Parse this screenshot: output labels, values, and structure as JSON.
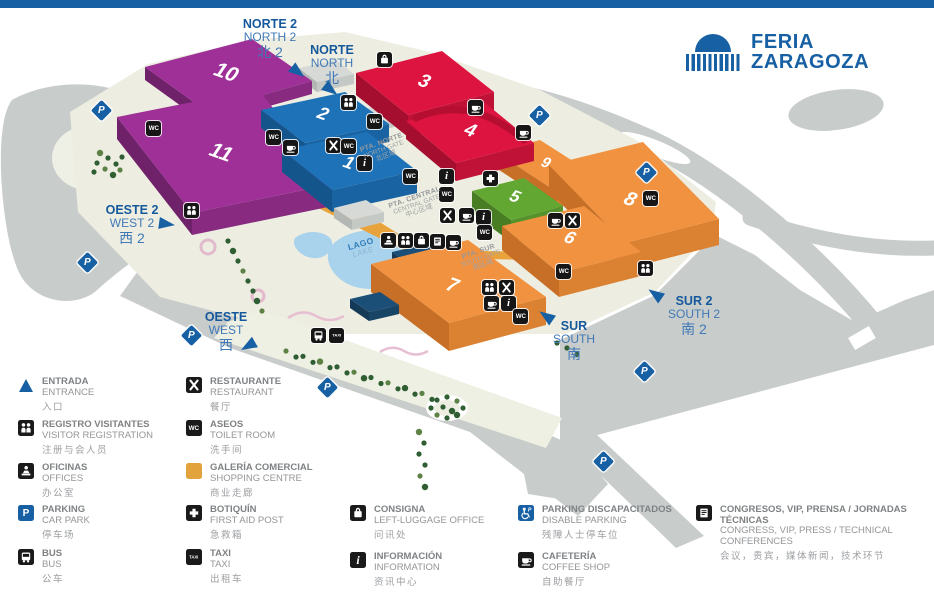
{
  "top_bar": {
    "color": "#1660a3"
  },
  "logo": {
    "line1": "FERIA",
    "line2": "ZARAGOZA",
    "color": "#1660a3"
  },
  "palette": {
    "ground": "#edeee1",
    "road": "#c8cccb",
    "lake": "#a9d2ec",
    "accent_blue": "#1660a3",
    "buildings": {
      "purple": {
        "roof": "#9e3097",
        "left": "#6f2169",
        "right": "#872a80"
      },
      "blue": {
        "roof": "#1e72b8",
        "left": "#14568c",
        "right": "#1963a2"
      },
      "red": {
        "roof": "#dd1440",
        "left": "#a60e2f",
        "right": "#c01137"
      },
      "orange": {
        "roof": "#f0923f",
        "left": "#c76f26",
        "right": "#db8132"
      },
      "green": {
        "roof": "#63a733",
        "left": "#497d24",
        "right": "#56922b"
      },
      "navy": {
        "roof": "#1c4f78",
        "left": "#143a58",
        "right": "#184466"
      },
      "gray": {
        "roof": "#d6d9d6",
        "left": "#b4b8b5",
        "right": "#c5c9c6"
      }
    }
  },
  "map": {
    "structures": [
      {
        "n": "",
        "c": "gray",
        "roof": [
          [
            299,
            68
          ],
          [
            336,
            60
          ],
          [
            354,
            74
          ],
          [
            317,
            82
          ]
        ],
        "h": 10
      },
      {
        "n": "",
        "c": "gray",
        "roof": [
          [
            352,
            112
          ],
          [
            380,
            105
          ],
          [
            398,
            118
          ],
          [
            370,
            125
          ]
        ],
        "h": 8
      },
      {
        "n": "10",
        "c": "purple",
        "roof": [
          [
            145,
            67
          ],
          [
            252,
            39
          ],
          [
            312,
            81
          ],
          [
            206,
            111
          ]
        ],
        "h": 13,
        "lx": 226,
        "ly": 73,
        "fs": 21
      },
      {
        "n": "11",
        "c": "purple",
        "roof": [
          [
            117,
            117
          ],
          [
            258,
            89
          ],
          [
            333,
            184
          ],
          [
            192,
            213
          ]
        ],
        "h": 22,
        "lx": 221,
        "ly": 153,
        "fs": 21
      },
      {
        "n": "2",
        "c": "blue",
        "roof": [
          [
            261,
            110
          ],
          [
            345,
            92
          ],
          [
            389,
            124
          ],
          [
            305,
            143
          ]
        ],
        "h": 18,
        "lx": 323,
        "ly": 114,
        "fs": 18
      },
      {
        "n": "1",
        "c": "blue",
        "roof": [
          [
            282,
            150
          ],
          [
            367,
            132
          ],
          [
            417,
            171
          ],
          [
            332,
            190
          ]
        ],
        "h": 22,
        "lx": 349,
        "ly": 163,
        "fs": 18
      },
      {
        "n": "3",
        "c": "red",
        "roof": [
          [
            356,
            73
          ],
          [
            442,
            51
          ],
          [
            494,
            92
          ],
          [
            408,
            115
          ]
        ],
        "h": 22,
        "lx": 424,
        "ly": 82,
        "fs": 19
      },
      {
        "n": "9",
        "c": "orange",
        "roof": [
          [
            496,
            152
          ],
          [
            540,
            140
          ],
          [
            601,
            179
          ],
          [
            557,
            192
          ]
        ],
        "h": 16,
        "lx": 546,
        "ly": 163,
        "fs": 15
      },
      {
        "n": "4",
        "c": "red",
        "roof": [
          [
            406,
            121
          ],
          [
            484,
            102
          ],
          [
            534,
            143
          ],
          [
            456,
            163
          ]
        ],
        "h": 18,
        "lx": 470,
        "ly": 131,
        "fs": 19,
        "dome": true
      },
      {
        "n": "8",
        "c": "orange",
        "roof": [
          [
            549,
            165
          ],
          [
            643,
            142
          ],
          [
            719,
            219
          ],
          [
            625,
            243
          ]
        ],
        "h": 26,
        "lx": 630,
        "ly": 200,
        "fs": 20
      },
      {
        "n": "5",
        "c": "green",
        "roof": [
          [
            472,
            191
          ],
          [
            524,
            178
          ],
          [
            563,
            206
          ],
          [
            511,
            220
          ]
        ],
        "h": 22,
        "lx": 515,
        "ly": 197,
        "fs": 17
      },
      {
        "n": "",
        "c": "gray",
        "roof": [
          [
            334,
            208
          ],
          [
            366,
            200
          ],
          [
            384,
            212
          ],
          [
            352,
            220
          ]
        ],
        "h": 10
      },
      {
        "n": "",
        "c": "navy",
        "roof": [
          [
            392,
            252
          ],
          [
            440,
            241
          ],
          [
            472,
            262
          ],
          [
            424,
            274
          ]
        ],
        "h": 13
      },
      {
        "n": "6",
        "c": "orange",
        "roof": [
          [
            502,
            226
          ],
          [
            584,
            206
          ],
          [
            641,
            252
          ],
          [
            559,
            273
          ]
        ],
        "h": 24,
        "lx": 570,
        "ly": 238,
        "fs": 18
      },
      {
        "n": "7",
        "c": "orange",
        "roof": [
          [
            371,
            264
          ],
          [
            468,
            240
          ],
          [
            546,
            297
          ],
          [
            449,
            323
          ]
        ],
        "h": 28,
        "lx": 452,
        "ly": 286,
        "fs": 20
      },
      {
        "n": "",
        "c": "navy",
        "roof": [
          [
            350,
            299
          ],
          [
            380,
            292
          ],
          [
            399,
            305
          ],
          [
            369,
            312
          ]
        ],
        "h": 9
      }
    ],
    "directions": [
      {
        "id": "norte2",
        "es": "NORTE 2",
        "en": "NORTH 2",
        "zh": "北 2",
        "x": 270,
        "y": 18,
        "ax": 298,
        "ay": 72,
        "rot": 38
      },
      {
        "id": "norte",
        "es": "NORTE",
        "en": "NORTH",
        "zh": "北",
        "x": 332,
        "y": 44,
        "ax": 331,
        "ay": 90,
        "rot": 38
      },
      {
        "id": "oeste2",
        "es": "OESTE 2",
        "en": "WEST 2",
        "zh": "西 2",
        "x": 132,
        "y": 204,
        "ax": 167,
        "ay": 224,
        "rot": 8
      },
      {
        "id": "oeste",
        "es": "OESTE",
        "en": "WEST",
        "zh": "西",
        "x": 226,
        "y": 311,
        "ax": 248,
        "ay": 346,
        "rot": 150
      },
      {
        "id": "sur",
        "es": "SUR",
        "en": "SOUTH",
        "zh": "南",
        "x": 574,
        "y": 320,
        "ax": 546,
        "ay": 316,
        "rot": 215
      },
      {
        "id": "sur2",
        "es": "SUR 2",
        "en": "SOUTH 2",
        "zh": "南 2",
        "x": 694,
        "y": 295,
        "ax": 655,
        "ay": 294,
        "rot": 215
      }
    ],
    "gates": [
      {
        "id": "pta-norte",
        "es": "PTA. NORTE",
        "en": "NORTH GATE",
        "zh": "北区域",
        "x": 384,
        "y": 150,
        "rot": -20
      },
      {
        "id": "pta-central",
        "es": "PTA. CENTRAL",
        "en": "CENTRAL GATE",
        "zh": "中心区域",
        "x": 417,
        "y": 205,
        "rot": -19
      },
      {
        "id": "pta-sur",
        "es": "PTA. SUR",
        "en": "SOUTH GATE",
        "zh": "南区域",
        "x": 481,
        "y": 259,
        "rot": -19
      }
    ],
    "lake_label": {
      "es": "LAGO",
      "en": "LAKE",
      "x": 362,
      "y": 248
    },
    "icons": [
      {
        "t": "wc",
        "x": 146,
        "y": 121
      },
      {
        "t": "wc",
        "x": 266,
        "y": 130
      },
      {
        "t": "coffee",
        "x": 283,
        "y": 140
      },
      {
        "t": "reg",
        "x": 341,
        "y": 95
      },
      {
        "t": "bag",
        "x": 377,
        "y": 52
      },
      {
        "t": "wc",
        "x": 367,
        "y": 114
      },
      {
        "t": "rest",
        "x": 326,
        "y": 138
      },
      {
        "t": "wc",
        "x": 341,
        "y": 139
      },
      {
        "t": "info",
        "x": 357,
        "y": 156
      },
      {
        "t": "coffee",
        "x": 468,
        "y": 100
      },
      {
        "t": "wc",
        "x": 403,
        "y": 169
      },
      {
        "t": "info",
        "x": 439,
        "y": 169
      },
      {
        "t": "wc",
        "x": 439,
        "y": 187
      },
      {
        "t": "aid",
        "x": 483,
        "y": 171
      },
      {
        "t": "coffee",
        "x": 516,
        "y": 125
      },
      {
        "t": "rest",
        "x": 440,
        "y": 208
      },
      {
        "t": "coffee",
        "x": 459,
        "y": 208
      },
      {
        "t": "info",
        "x": 476,
        "y": 210
      },
      {
        "t": "wc",
        "x": 477,
        "y": 225
      },
      {
        "t": "ofi",
        "x": 381,
        "y": 233
      },
      {
        "t": "reg",
        "x": 398,
        "y": 233
      },
      {
        "t": "bag",
        "x": 414,
        "y": 233
      },
      {
        "t": "cong",
        "x": 430,
        "y": 234
      },
      {
        "t": "coffee",
        "x": 446,
        "y": 235
      },
      {
        "t": "reg",
        "x": 482,
        "y": 280
      },
      {
        "t": "rest",
        "x": 499,
        "y": 280
      },
      {
        "t": "coffee",
        "x": 484,
        "y": 296
      },
      {
        "t": "info",
        "x": 501,
        "y": 296
      },
      {
        "t": "wc",
        "x": 513,
        "y": 309
      },
      {
        "t": "coffee",
        "x": 548,
        "y": 213
      },
      {
        "t": "rest",
        "x": 565,
        "y": 213
      },
      {
        "t": "wc",
        "x": 556,
        "y": 264
      },
      {
        "t": "wc",
        "x": 643,
        "y": 191
      },
      {
        "t": "reg",
        "x": 638,
        "y": 261
      },
      {
        "t": "bus",
        "x": 311,
        "y": 328
      },
      {
        "t": "taxi",
        "x": 329,
        "y": 328
      },
      {
        "t": "reg",
        "x": 184,
        "y": 203
      }
    ],
    "parkings": [
      {
        "x": 102,
        "y": 111
      },
      {
        "x": 540,
        "y": 116
      },
      {
        "x": 647,
        "y": 173
      },
      {
        "x": 88,
        "y": 263
      },
      {
        "x": 192,
        "y": 336
      },
      {
        "x": 328,
        "y": 388
      },
      {
        "x": 645,
        "y": 372
      },
      {
        "x": 604,
        "y": 462
      }
    ],
    "parking_glyph": "P"
  },
  "legend": {
    "columns": [
      {
        "items": [
          {
            "icon": "entrance",
            "es": "ENTRADA",
            "en": "ENTRANCE",
            "zh": "入口"
          },
          {
            "icon": "reg",
            "es": "REGISTRO VISITANTES",
            "en": "VISITOR REGISTRATION",
            "zh": "注册与会人员"
          },
          {
            "icon": "ofi",
            "es": "OFICINAS",
            "en": "OFFICES",
            "zh": "办公室"
          },
          {
            "icon": "park",
            "es": "PARKING",
            "en": "CAR PARK",
            "zh": "停车场"
          },
          {
            "icon": "bus",
            "es": "BUS",
            "en": "BUS",
            "zh": "公车"
          }
        ]
      },
      {
        "items": [
          {
            "icon": "rest",
            "es": "RESTAURANTE",
            "en": "RESTAURANT",
            "zh": "餐厅"
          },
          {
            "icon": "wc",
            "es": "ASEOS",
            "en": "TOILET ROOM",
            "zh": "洗手间"
          },
          {
            "icon": "shop",
            "es": "GALERÍA COMERCIAL",
            "en": "SHOPPING CENTRE",
            "zh": "商业走廊"
          },
          {
            "icon": "aid",
            "es": "BOTIQUÍN",
            "en": "FIRST AID POST",
            "zh": "急救箱"
          },
          {
            "icon": "taxi",
            "es": "TAXI",
            "en": "TAXI",
            "zh": "出租车"
          }
        ]
      },
      {
        "items": [
          {
            "icon": "bag",
            "es": "CONSIGNA",
            "en": "LEFT-LUGGAGE OFFICE",
            "zh": "问讯处"
          },
          {
            "icon": "info",
            "es": "INFORMACIÓN",
            "en": "INFORMATION",
            "zh": "资讯中心"
          }
        ]
      },
      {
        "items": [
          {
            "icon": "dis",
            "es": "PARKING DISCAPACITADOS",
            "en": "DISABLE PARKING",
            "zh": "残障人士停车位"
          },
          {
            "icon": "coffee",
            "es": "CAFETERÍA",
            "en": "COFFEE SHOP",
            "zh": "自助餐厅"
          }
        ]
      },
      {
        "items": [
          {
            "icon": "cong",
            "es": "CONGRESOS, VIP, PRENSA / JORNADAS TÉCNICAS",
            "en": "CONGRESS, VIP, PRESS / TECHNICAL CONFERENCES",
            "zh": "会议，贵宾，媒体新闻，技术环节"
          }
        ]
      }
    ]
  }
}
